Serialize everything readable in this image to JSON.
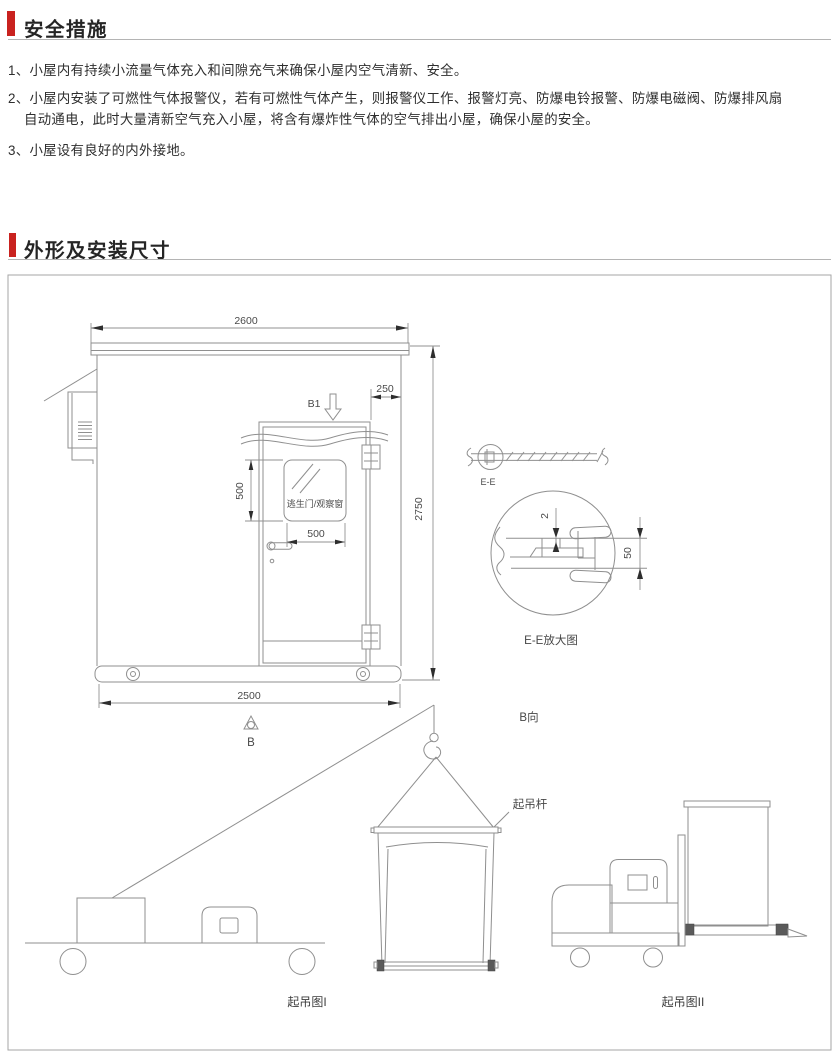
{
  "sections": [
    {
      "title": "安全措施"
    },
    {
      "title": "外形及安装尺寸"
    }
  ],
  "safety": {
    "lines": [
      {
        "text": "1、小屋内有持续小流量气体充入和间隙充气来确保小屋内空气清新、安全。"
      },
      {
        "text": "2、小屋内安装了可燃性气体报警仪，若有可燃性气体产生，则报警仪工作、报警灯亮、防爆电铃报警、防爆电磁阀、防爆排风扇"
      },
      {
        "text": "自动通电，此时大量清新空气充入小屋，将含有爆炸性气体的空气排出小屋，确保小屋的安全。"
      },
      {
        "text": "3、小屋设有良好的内外接地。"
      }
    ]
  },
  "drawing": {
    "dimensions": {
      "top_width": "2600",
      "overall_height": "2750",
      "base_width": "2500",
      "door_to_corner": "250",
      "window_height": "500",
      "window_width": "500",
      "seam_gap": "2",
      "seam_height": "50"
    },
    "labels": {
      "view_b1": "B1",
      "view_b": "B",
      "view_b_direction": "B向",
      "section_ee": "E-E",
      "section_ee_detail": "E-E放大图",
      "escape_door_window": "逃生门/观察窗",
      "lifting_bar": "起吊杆",
      "lifting_fig_1": "起吊图I",
      "lifting_fig_2": "起吊图II"
    }
  },
  "colors": {
    "accent_red": "#c9221f",
    "line_gray": "#8f8f8f",
    "text_dark": "#2e2e2e"
  }
}
